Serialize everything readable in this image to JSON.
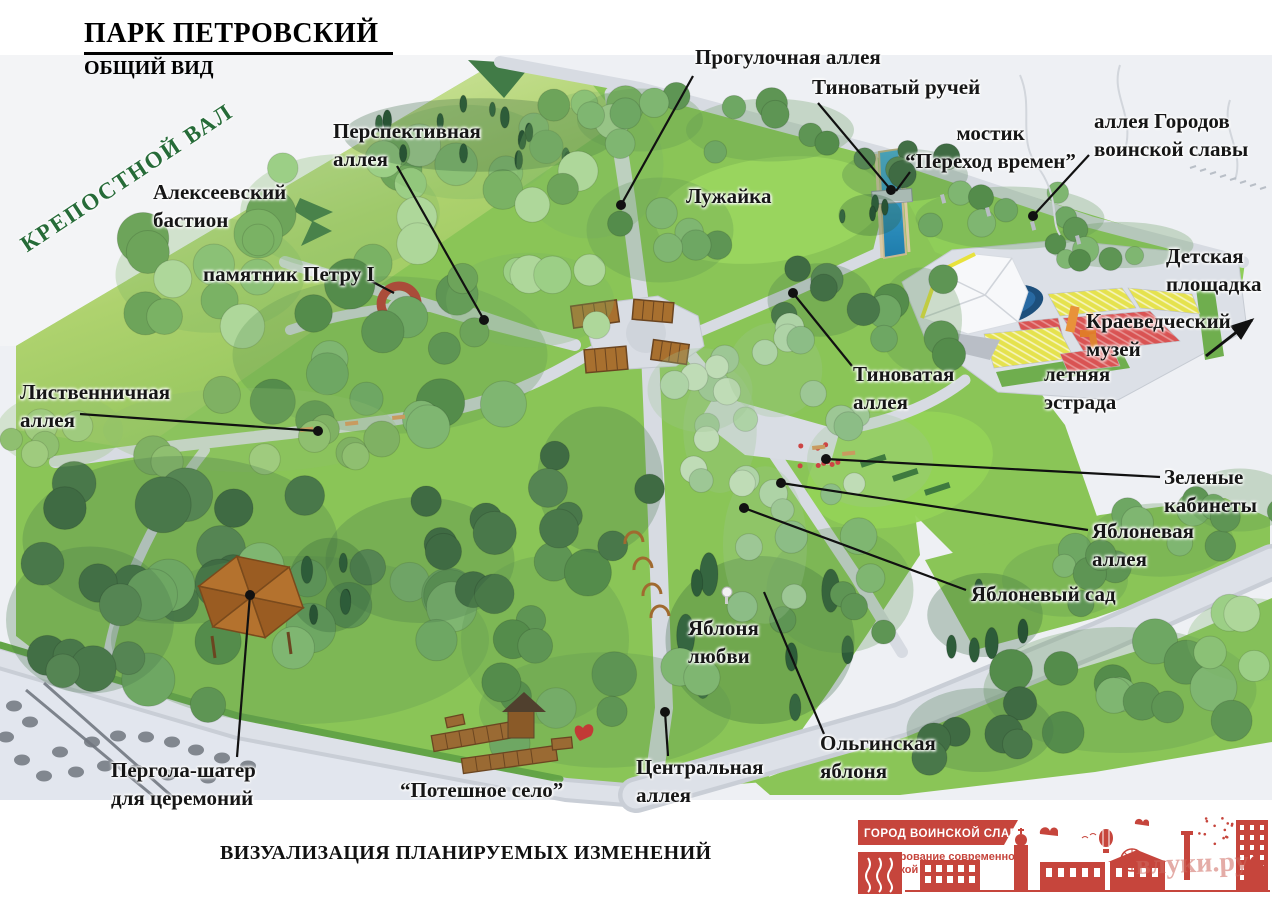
{
  "header": {
    "title": "ПАРК ПЕТРОВСКИЙ",
    "subtitle": "ОБЩИЙ ВИД"
  },
  "caption": "ВИЗУАЛИЗАЦИЯ ПЛАНИРУЕМЫХ ИЗМЕНЕНИЙ",
  "rampart": {
    "text": "КРЕПОСТНОЙ ВАЛ",
    "color": "#266b38"
  },
  "labels": [
    {
      "id": "progulochnaya",
      "lines": [
        "Прогулочная аллея"
      ],
      "x": 695,
      "y": 44,
      "leader": {
        "x1": 693,
        "y1": 76,
        "x2": 621,
        "y2": 205,
        "dot": "end"
      }
    },
    {
      "id": "tinovaty-ruchey",
      "lines": [
        "Тиноватый ручей"
      ],
      "x": 812,
      "y": 74,
      "leader": {
        "x1": 818,
        "y1": 103,
        "x2": 891,
        "y2": 190,
        "dot": "end"
      }
    },
    {
      "id": "mostik",
      "lines": [
        "мостик",
        "“Переход времен”"
      ],
      "x": 898,
      "y": 120,
      "align": "center",
      "w": 185,
      "leader": {
        "x1": 910,
        "y1": 172,
        "x2": 896,
        "y2": 191,
        "dot": "none"
      }
    },
    {
      "id": "alleya-gorodov",
      "lines": [
        "аллея Городов",
        "воинской славы"
      ],
      "x": 1094,
      "y": 108,
      "leader": {
        "x1": 1089,
        "y1": 155,
        "x2": 1033,
        "y2": 216,
        "dot": "end"
      }
    },
    {
      "id": "perspektivnaya",
      "lines": [
        "Перспективная",
        "аллея"
      ],
      "x": 333,
      "y": 118,
      "leader": {
        "x1": 397,
        "y1": 166,
        "x2": 484,
        "y2": 320,
        "dot": "end"
      }
    },
    {
      "id": "alekseevsky-bastion",
      "lines": [
        "Алексеевский",
        "бастион"
      ],
      "x": 153,
      "y": 179
    },
    {
      "id": "pamyatnik-petru",
      "lines": [
        "памятник Петру I"
      ],
      "x": 203,
      "y": 261,
      "leader": {
        "x1": 371,
        "y1": 281,
        "x2": 394,
        "y2": 293,
        "dot": "none"
      }
    },
    {
      "id": "luzhayka",
      "lines": [
        "Лужайка"
      ],
      "x": 686,
      "y": 183
    },
    {
      "id": "detskaya-ploschadka",
      "lines": [
        "Детская",
        "площадка"
      ],
      "x": 1166,
      "y": 243
    },
    {
      "id": "kraevedchesky-muzey",
      "lines": [
        "Краеведческий",
        "музей"
      ],
      "x": 1086,
      "y": 308,
      "leader": {
        "x1": 1206,
        "y1": 356,
        "x2": 1252,
        "y2": 320,
        "dot": "arrow"
      }
    },
    {
      "id": "letnyaya-estrada",
      "lines": [
        "летняя",
        "эстрада"
      ],
      "x": 1044,
      "y": 361
    },
    {
      "id": "tinovataya-alleya",
      "lines": [
        "Тиноватая",
        "аллея"
      ],
      "x": 853,
      "y": 361,
      "leader": {
        "x1": 852,
        "y1": 366,
        "x2": 793,
        "y2": 293,
        "dot": "end"
      }
    },
    {
      "id": "listvennichnaya",
      "lines": [
        "Лиственничная",
        "аллея"
      ],
      "x": 20,
      "y": 379,
      "leader": {
        "x1": 80,
        "y1": 414,
        "x2": 318,
        "y2": 431,
        "dot": "end"
      }
    },
    {
      "id": "zelenye-kabinety",
      "lines": [
        "Зеленые",
        "кабинеты"
      ],
      "x": 1164,
      "y": 464,
      "leader": {
        "x1": 1160,
        "y1": 477,
        "x2": 826,
        "y2": 459,
        "dot": "end"
      }
    },
    {
      "id": "yablonevaya-alleya",
      "lines": [
        "Яблоневая",
        "аллея"
      ],
      "x": 1092,
      "y": 518,
      "leader": {
        "x1": 1088,
        "y1": 530,
        "x2": 781,
        "y2": 483,
        "dot": "end"
      }
    },
    {
      "id": "yablonevy-sad",
      "lines": [
        "Яблоневый сад"
      ],
      "x": 971,
      "y": 581,
      "leader": {
        "x1": 966,
        "y1": 590,
        "x2": 744,
        "y2": 508,
        "dot": "end"
      }
    },
    {
      "id": "yablonya-lyubvi",
      "lines": [
        "Яблоня",
        "любви"
      ],
      "x": 688,
      "y": 615
    },
    {
      "id": "olginskaya-yablonya",
      "lines": [
        "Ольгинская",
        "яблоня"
      ],
      "x": 820,
      "y": 730,
      "leader": {
        "x1": 824,
        "y1": 734,
        "x2": 764,
        "y2": 592,
        "dot": "none"
      }
    },
    {
      "id": "pergola-shater",
      "lines": [
        "Пергола-шатер",
        "для церемоний"
      ],
      "x": 111,
      "y": 757,
      "leader": {
        "x1": 237,
        "y1": 757,
        "x2": 250,
        "y2": 595,
        "dot": "end"
      }
    },
    {
      "id": "poteshnoe-selo",
      "lines": [
        "“Потешное село”"
      ],
      "x": 400,
      "y": 777
    },
    {
      "id": "tsentralnaya-alleya",
      "lines": [
        "Центральная",
        "аллея"
      ],
      "x": 636,
      "y": 754,
      "leader": {
        "x1": 668,
        "y1": 756,
        "x2": 665,
        "y2": 712,
        "dot": "end"
      }
    }
  ],
  "logo": {
    "banner": "ГОРОД ВОИНСКОЙ СЛАВЫ",
    "subtitle_lines": [
      "Формирование современной",
      "городской среды"
    ],
    "watermark": "влуки.ру",
    "red": "#c6453c"
  },
  "colors": {
    "outside": "#eef0f4",
    "street": "#e2e6ee",
    "lawn": "#8ac557",
    "lawn_bright": "#9ad65f",
    "water": "#2f9fd0",
    "path": "#d7dbe2",
    "path_dark": "#c9ced6",
    "seat_red": "#d95353",
    "seat_yellow": "#e5e24e",
    "canopy": "#f7f8fa",
    "wood": "#a8702f",
    "wood_dark": "#6b4520",
    "monument_red": "#c83131",
    "hedge": "#63a447",
    "label": "#161616"
  }
}
